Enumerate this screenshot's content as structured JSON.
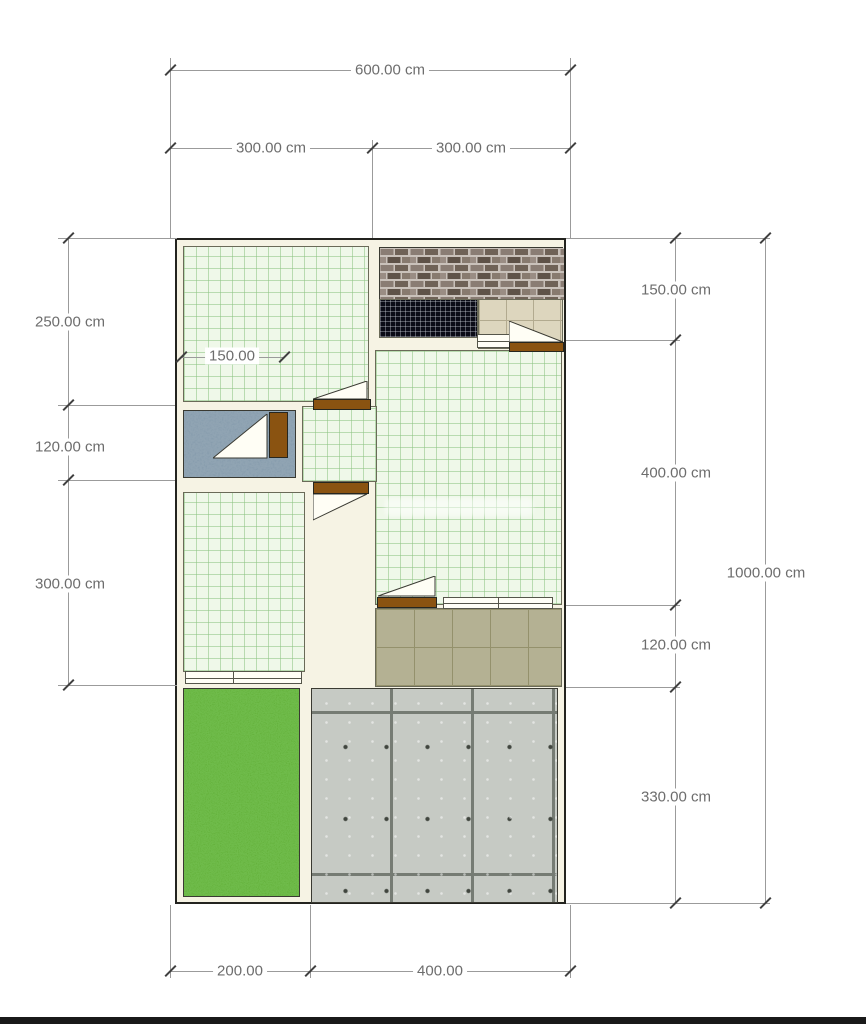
{
  "title": "house-floor-plan",
  "dimensions": {
    "top_total": "600.00 cm",
    "top_left": "300.00 cm",
    "top_right": "300.00 cm",
    "left_upper": "250.00 cm",
    "left_middle": "120.00 cm",
    "left_lower": "300.00 cm",
    "interior_width": "150.00",
    "right_top": "150.00 cm",
    "right_upper": "400.00 cm",
    "right_lower": "120.00 cm",
    "right_bottom": "330.00 cm",
    "right_total": "1000.00 cm",
    "bottom_left": "200.00",
    "bottom_right": "400.00"
  },
  "areas": [
    {
      "name": "room-top-left",
      "surface": "green-grid-tile"
    },
    {
      "name": "service-area",
      "surface": "brick-and-black-tile"
    },
    {
      "name": "main-hall",
      "surface": "green-grid-tile"
    },
    {
      "name": "bathroom",
      "surface": "blue-mosaic-tile"
    },
    {
      "name": "room-bottom-left",
      "surface": "green-grid-tile"
    },
    {
      "name": "terrace",
      "surface": "khaki-tile"
    },
    {
      "name": "garden",
      "surface": "grass"
    },
    {
      "name": "carport",
      "surface": "concrete-panels"
    }
  ],
  "colors": {
    "wall_fill": "#f6f3e4",
    "wall_edge": "#23231f",
    "room_tile": "#eff8e9",
    "room_grid": "#8cc382",
    "bathroom_tile": "#7e96a8",
    "black_tile": "#0b0b17",
    "beige_tile": "#ddd6be",
    "terrace_tile": "#b4b193",
    "grass": "#57a62a",
    "concrete": "#c6cac4",
    "door": "#8a5311",
    "dim_text": "#6d6d6d",
    "dim_line": "#9b9b9b"
  }
}
